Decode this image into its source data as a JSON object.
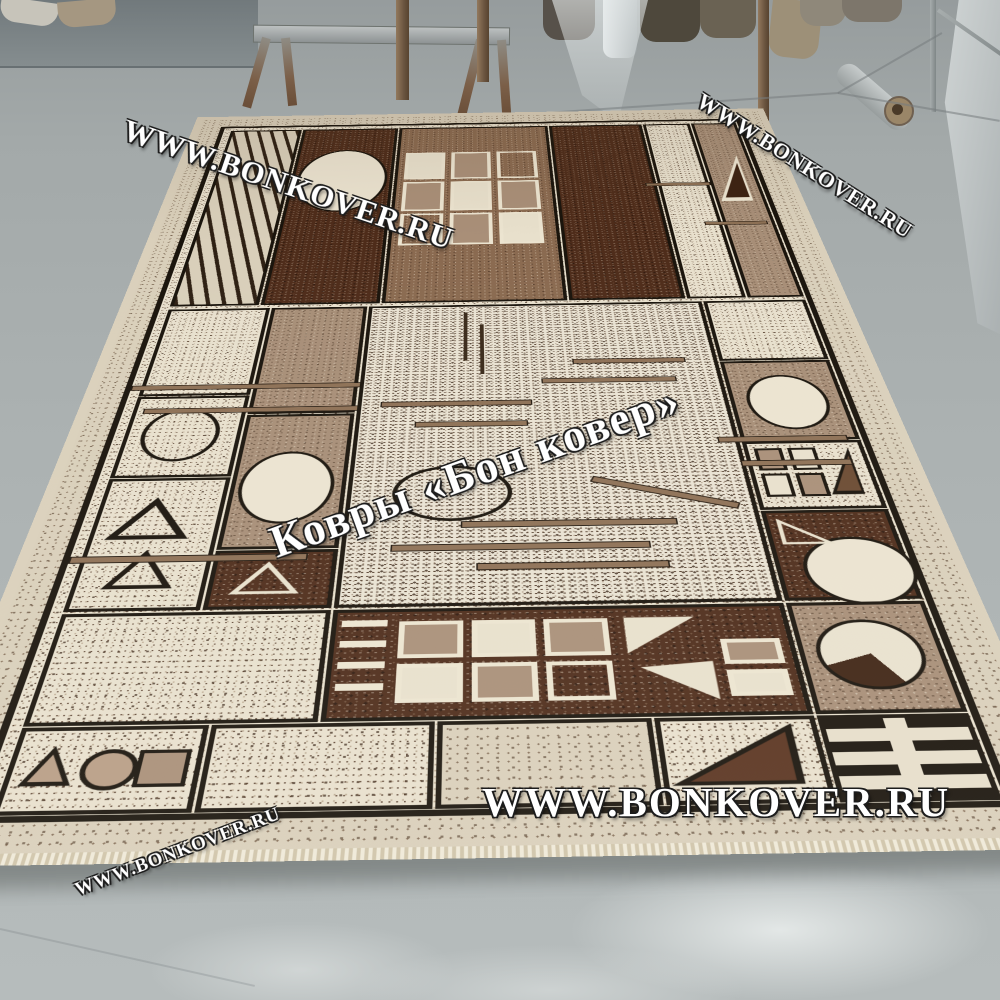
{
  "scene": {
    "subject": "geometric beige-brown rug displayed on a gray workshop floor",
    "background_objects": [
      "carpet rolls",
      "metal stand",
      "plastic film",
      "leaning sheet roll",
      "metal rack",
      "floor pipe"
    ]
  },
  "watermarks": {
    "top_left": "WWW.BONKOVER.RU",
    "top_right": "WWW.BONKOVER.RU",
    "center": "Ковры «Бон ковер»",
    "bottom": "WWW.BONKOVER.RU",
    "bottom_left": "WWW.BONKOVER.RU"
  },
  "palette": {
    "floor": "#aeb4b5",
    "wall": "#7b8386",
    "rug_cream": "#e8e0cd",
    "rug_beige": "#d9cfba",
    "rug_tan": "#a78e77",
    "rug_brown": "#8a6a50",
    "rug_dark_brown": "#4e2c1a",
    "rug_outline": "#1a140c",
    "watermark_text": "#ffffff"
  }
}
